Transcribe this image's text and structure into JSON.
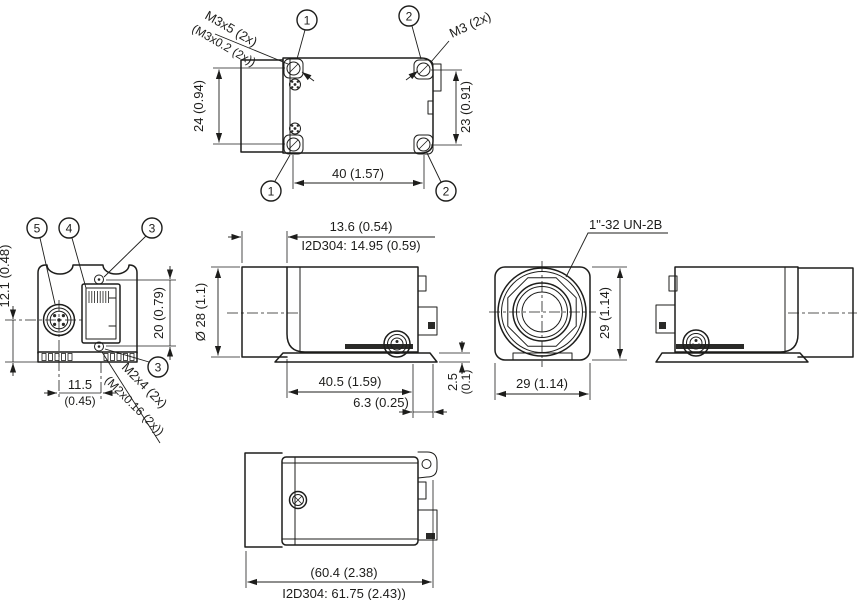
{
  "callouts": {
    "n1": "1",
    "n2": "2",
    "n3": "3",
    "n4": "4",
    "n5": "5"
  },
  "top_view": {
    "screw_label_line1": "M3x5 (2x)",
    "screw_label_line2": "(M3x0.2 (2x))",
    "thread_label": "M3 (2x)",
    "dim_left": "24 (0.94)",
    "dim_right": "23 (0.91)",
    "dim_width": "40 (1.57)"
  },
  "rear_view": {
    "dim_connector_height": "12.1 (0.48)",
    "dim_screw_spacing": "20 (0.79)",
    "dim_offset_mm": "11.5",
    "dim_offset_in": "(0.45)",
    "screw_label_line1": "M2x4 (2x)",
    "screw_label_line2": "(M2x0.16 (2x))"
  },
  "side_view": {
    "dim_front": "13.6 (0.54)",
    "dim_front_variant": "I2D304: 14.95 (0.59)",
    "dim_diameter": "Ø 28 (1.1)",
    "dim_body_length": "40.5 (1.59)",
    "dim_rear": "6.3 (0.25)",
    "dim_plate_mm": "2.5",
    "dim_plate_in": "(0.1)"
  },
  "front_view": {
    "thread_label": "1\"-32 UN-2B",
    "dim_height": "29 (1.14)",
    "dim_width": "29 (1.14)"
  },
  "bottom_view": {
    "dim_length_line1": "(60.4 (2.38)",
    "dim_length_line2": "I2D304: 61.75 (2.43))"
  }
}
